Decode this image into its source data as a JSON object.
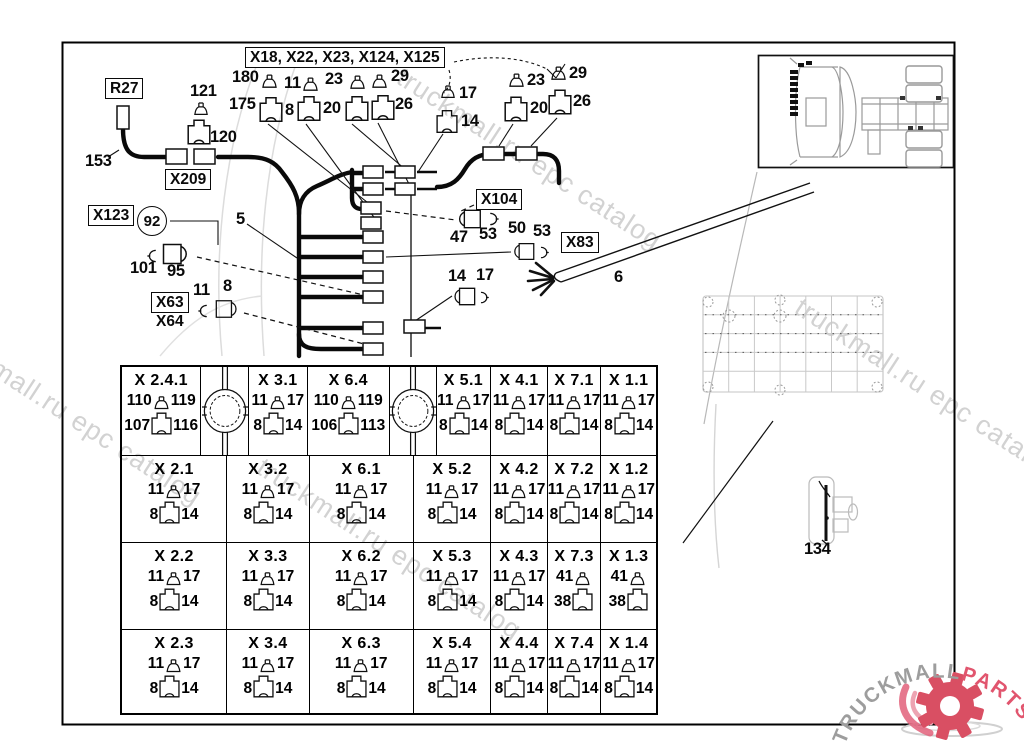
{
  "watermark": {
    "text": "truckmall.ru epc catalog",
    "color": "#c7c7c7"
  },
  "logo": {
    "truckmall": "TRUCKMALL",
    "parts": "PARTS",
    "text_color": "#9d9d9d",
    "parts_color": "#e1556e",
    "gear_color": "#d94f63"
  },
  "diagram": {
    "labels": [
      {
        "id": "r27",
        "kind": "boxed",
        "text": "R27",
        "x": 105,
        "y": 78
      },
      {
        "id": "x209",
        "kind": "boxed",
        "text": "X209",
        "x": 165,
        "y": 169
      },
      {
        "id": "x123",
        "kind": "boxed",
        "text": "X123",
        "x": 88,
        "y": 205
      },
      {
        "id": "x104",
        "kind": "boxed",
        "text": "X104",
        "x": 476,
        "y": 189
      },
      {
        "id": "x83",
        "kind": "boxed",
        "text": "X83",
        "x": 561,
        "y": 232
      },
      {
        "id": "x63-x64",
        "kind": "boxed",
        "text": "X63",
        "text2": "X64",
        "x": 151,
        "y": 292
      },
      {
        "id": "group-title",
        "kind": "boxed",
        "text": "X18, X22, X23, X124, X125",
        "x": 245,
        "y": 47
      },
      {
        "id": "c92",
        "kind": "circle",
        "text": "92",
        "x": 137,
        "y": 206
      },
      {
        "id": "n153",
        "kind": "plain",
        "text": "153",
        "x": 85,
        "y": 152
      },
      {
        "id": "n121",
        "kind": "plain",
        "text": "121",
        "x": 190,
        "y": 82
      },
      {
        "id": "n120",
        "kind": "plain",
        "text": "120",
        "x": 210,
        "y": 128
      },
      {
        "id": "n101",
        "kind": "plain",
        "text": "101",
        "x": 130,
        "y": 259
      },
      {
        "id": "n95",
        "kind": "plain",
        "text": "95",
        "x": 167,
        "y": 262
      },
      {
        "id": "n11-left",
        "kind": "plain",
        "text": "11",
        "x": 193,
        "y": 281
      },
      {
        "id": "n8-left",
        "kind": "plain",
        "text": "8",
        "x": 223,
        "y": 277
      },
      {
        "id": "n5",
        "kind": "plain",
        "text": "5",
        "x": 236,
        "y": 210
      },
      {
        "id": "n180",
        "kind": "plain",
        "text": "180",
        "x": 232,
        "y": 68
      },
      {
        "id": "n11-top",
        "kind": "plain",
        "text": "11",
        "x": 284,
        "y": 74
      },
      {
        "id": "n23-top",
        "kind": "plain",
        "text": "23",
        "x": 325,
        "y": 70
      },
      {
        "id": "n29-top",
        "kind": "plain",
        "text": "29",
        "x": 391,
        "y": 67
      },
      {
        "id": "n175",
        "kind": "plain",
        "text": "175",
        "x": 229,
        "y": 95
      },
      {
        "id": "n8-top",
        "kind": "plain",
        "text": "8",
        "x": 285,
        "y": 101
      },
      {
        "id": "n20-top",
        "kind": "plain",
        "text": "20",
        "x": 323,
        "y": 99
      },
      {
        "id": "n26-top",
        "kind": "plain",
        "text": "26",
        "x": 395,
        "y": 95
      },
      {
        "id": "n17-a",
        "kind": "plain",
        "text": "17",
        "x": 459,
        "y": 84
      },
      {
        "id": "n14-a",
        "kind": "plain",
        "text": "14",
        "x": 461,
        "y": 112
      },
      {
        "id": "n23-b",
        "kind": "plain",
        "text": "23",
        "x": 527,
        "y": 71
      },
      {
        "id": "n29-b",
        "kind": "plain",
        "text": "29",
        "x": 569,
        "y": 64
      },
      {
        "id": "n20-b",
        "kind": "plain",
        "text": "20",
        "x": 530,
        "y": 99
      },
      {
        "id": "n26-b",
        "kind": "plain",
        "text": "26",
        "x": 573,
        "y": 92
      },
      {
        "id": "n47",
        "kind": "plain",
        "text": "47",
        "x": 450,
        "y": 228
      },
      {
        "id": "n53-a",
        "kind": "plain",
        "text": "53",
        "x": 479,
        "y": 225
      },
      {
        "id": "n50",
        "kind": "plain",
        "text": "50",
        "x": 508,
        "y": 219
      },
      {
        "id": "n53-b",
        "kind": "plain",
        "text": "53",
        "x": 533,
        "y": 222
      },
      {
        "id": "n6",
        "kind": "plain",
        "text": "6",
        "x": 614,
        "y": 268
      },
      {
        "id": "n14-b",
        "kind": "plain",
        "text": "14",
        "x": 448,
        "y": 267
      },
      {
        "id": "n17-b",
        "kind": "plain",
        "text": "17",
        "x": 476,
        "y": 266
      },
      {
        "id": "n134",
        "kind": "plain",
        "text": "134",
        "x": 804,
        "y": 540
      }
    ]
  },
  "table": {
    "rows": [
      {
        "h": 90,
        "cells": [
          {
            "type": "conn",
            "w": 80,
            "title": "X 2.4.1",
            "pin": [
              "110",
              "119"
            ],
            "plug": [
              "107",
              "116"
            ]
          },
          {
            "type": "circle",
            "w": 48
          },
          {
            "type": "conn",
            "w": 59,
            "title": "X 3.1",
            "pin": [
              "11",
              "17"
            ],
            "plug": [
              "8",
              "14"
            ]
          },
          {
            "type": "conn",
            "w": 83,
            "title": "X 6.4",
            "pin": [
              "110",
              "119"
            ],
            "plug": [
              "106",
              "113"
            ]
          },
          {
            "type": "circle",
            "w": 47
          },
          {
            "type": "conn",
            "w": 55,
            "title": "X 5.1",
            "pin": [
              "11",
              "17"
            ],
            "plug": [
              "8",
              "14"
            ]
          },
          {
            "type": "conn",
            "w": 57,
            "title": "X 4.1",
            "pin": [
              "11",
              "17"
            ],
            "plug": [
              "8",
              "14"
            ]
          },
          {
            "type": "conn",
            "w": 54,
            "title": "X 7.1",
            "pin": [
              "11",
              "17"
            ],
            "plug": [
              "8",
              "14"
            ]
          },
          {
            "type": "conn",
            "w": 55,
            "title": "X 1.1",
            "pin": [
              "11",
              "17"
            ],
            "plug": [
              "8",
              "14"
            ]
          }
        ]
      },
      {
        "h": 88,
        "cells": [
          {
            "type": "conn",
            "w": 106,
            "title": "X 2.1",
            "pin": [
              "11",
              "17"
            ],
            "plug": [
              "8",
              "14"
            ]
          },
          {
            "type": "conn",
            "w": 83,
            "title": "X 3.2",
            "pin": [
              "11",
              "17"
            ],
            "plug": [
              "8",
              "14"
            ]
          },
          {
            "type": "conn",
            "w": 105,
            "title": "X 6.1",
            "pin": [
              "11",
              "17"
            ],
            "plug": [
              "8",
              "14"
            ]
          },
          {
            "type": "conn",
            "w": 78,
            "title": "X 5.2",
            "pin": [
              "11",
              "17"
            ],
            "plug": [
              "8",
              "14"
            ]
          },
          {
            "type": "conn",
            "w": 57,
            "title": "X 4.2",
            "pin": [
              "11",
              "17"
            ],
            "plug": [
              "8",
              "14"
            ]
          },
          {
            "type": "conn",
            "w": 54,
            "title": "X 7.2",
            "pin": [
              "11",
              "17"
            ],
            "plug": [
              "8",
              "14"
            ]
          },
          {
            "type": "conn",
            "w": 55,
            "title": "X 1.2",
            "pin": [
              "11",
              "17"
            ],
            "plug": [
              "8",
              "14"
            ]
          }
        ]
      },
      {
        "h": 88,
        "cells": [
          {
            "type": "conn",
            "w": 106,
            "title": "X 2.2",
            "pin": [
              "11",
              "17"
            ],
            "plug": [
              "8",
              "14"
            ]
          },
          {
            "type": "conn",
            "w": 83,
            "title": "X 3.3",
            "pin": [
              "11",
              "17"
            ],
            "plug": [
              "8",
              "14"
            ]
          },
          {
            "type": "conn",
            "w": 105,
            "title": "X 6.2",
            "pin": [
              "11",
              "17"
            ],
            "plug": [
              "8",
              "14"
            ]
          },
          {
            "type": "conn",
            "w": 78,
            "title": "X 5.3",
            "pin": [
              "11",
              "17"
            ],
            "plug": [
              "8",
              "14"
            ]
          },
          {
            "type": "conn",
            "w": 57,
            "title": "X 4.3",
            "pin": [
              "11",
              "17"
            ],
            "plug": [
              "8",
              "14"
            ]
          },
          {
            "type": "conn",
            "w": 54,
            "title": "X 7.3",
            "pin": [
              "41",
              ""
            ],
            "plug": [
              "38",
              ""
            ]
          },
          {
            "type": "conn",
            "w": 55,
            "title": "X 1.3",
            "pin": [
              "41",
              ""
            ],
            "plug": [
              "38",
              ""
            ]
          }
        ]
      },
      {
        "h": 84,
        "cells": [
          {
            "type": "conn",
            "w": 106,
            "title": "X 2.3",
            "pin": [
              "11",
              "17"
            ],
            "plug": [
              "8",
              "14"
            ]
          },
          {
            "type": "conn",
            "w": 83,
            "title": "X 3.4",
            "pin": [
              "11",
              "17"
            ],
            "plug": [
              "8",
              "14"
            ]
          },
          {
            "type": "conn",
            "w": 105,
            "title": "X 6.3",
            "pin": [
              "11",
              "17"
            ],
            "plug": [
              "8",
              "14"
            ]
          },
          {
            "type": "conn",
            "w": 78,
            "title": "X 5.4",
            "pin": [
              "11",
              "17"
            ],
            "plug": [
              "8",
              "14"
            ]
          },
          {
            "type": "conn",
            "w": 57,
            "title": "X 4.4",
            "pin": [
              "11",
              "17"
            ],
            "plug": [
              "8",
              "14"
            ]
          },
          {
            "type": "conn",
            "w": 54,
            "title": "X 7.4",
            "pin": [
              "11",
              "17"
            ],
            "plug": [
              "8",
              "14"
            ]
          },
          {
            "type": "conn",
            "w": 55,
            "title": "X 1.4",
            "pin": [
              "11",
              "17"
            ],
            "plug": [
              "8",
              "14"
            ]
          }
        ]
      }
    ]
  }
}
